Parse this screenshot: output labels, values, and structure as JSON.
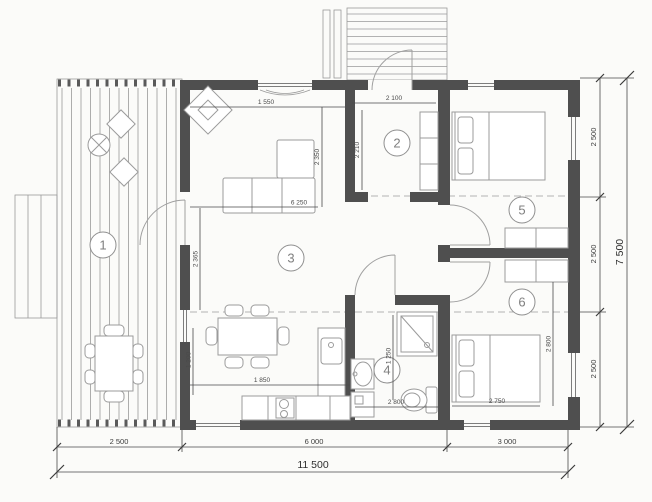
{
  "colors": {
    "wall": "#4f4f4f",
    "furniture_line": "#9b9b9b",
    "dimension_text": "#3c3c3c",
    "paper": "#fbfbf9"
  },
  "rooms": [
    {
      "number": "1"
    },
    {
      "number": "2"
    },
    {
      "number": "3"
    },
    {
      "number": "4"
    },
    {
      "number": "5"
    },
    {
      "number": "6"
    }
  ],
  "dimensions": {
    "bottom": {
      "deck": "2 500",
      "center": "6 000",
      "right": "3 000",
      "total": "11 500"
    },
    "right": {
      "top": "2 500",
      "middle": "2 500",
      "bottom": "2 500",
      "total": "7 500"
    },
    "interior": {
      "living_top_width": "1 550",
      "living_depth": "2 350",
      "living_width": "6 250",
      "entry_width": "2 100",
      "entry_depth": "2 210",
      "kitchen_width": "1 850",
      "kitchen_side": "1 200",
      "deck_doorway": "2 365",
      "bath_width": "2 800",
      "bath_shower": "1 250",
      "bedroom6_bed_width": "2 750",
      "bedroom6_depth": "2 800"
    }
  }
}
